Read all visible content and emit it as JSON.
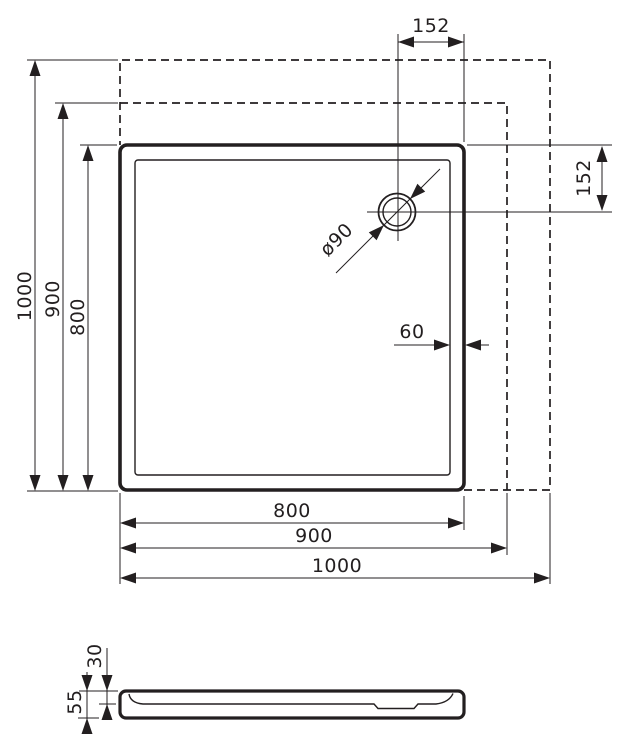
{
  "colors": {
    "line": "#231f20",
    "background": "#ffffff"
  },
  "plan_view": {
    "drain_offset_top": "152",
    "drain_offset_right": "152",
    "drain_diameter": "ø90",
    "rim_width": "60",
    "height_dims": {
      "outer": "1000",
      "middle": "900",
      "inner": "800"
    },
    "width_dims": {
      "inner": "800",
      "middle": "900",
      "outer": "1000"
    }
  },
  "side_view": {
    "basin_depth": "30",
    "total_height": "55"
  }
}
